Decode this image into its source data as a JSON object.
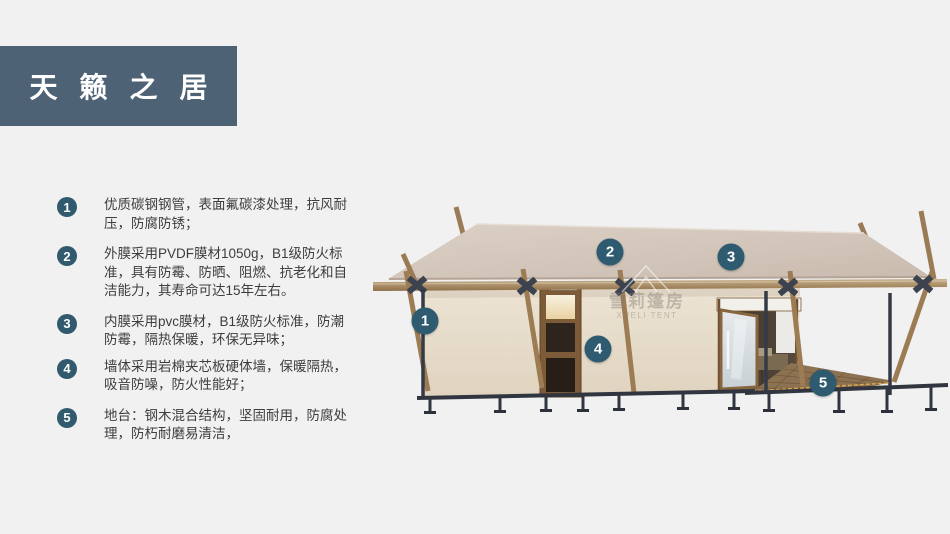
{
  "title": "天籁之居",
  "features": [
    {
      "num": "1",
      "text": "优质碳钢钢管，表面氟碳漆处理，抗风耐压，防腐防锈；"
    },
    {
      "num": "2",
      "text": "外膜采用PVDF膜材1050g，B1级防火标准，具有防霉、防晒、阻燃、抗老化和自洁能力，其寿命可达15年左右。"
    },
    {
      "num": "3",
      "text": "内膜采用pvc膜材，B1级防火标准，防潮防霉，隔热保暖，环保无异味；"
    },
    {
      "num": "4",
      "text": "墙体采用岩棉夹芯板硬体墙，保暖隔热，吸音防噪，防火性能好；"
    },
    {
      "num": "5",
      "text": "地台：钢木混合结构，坚固耐用，防腐处理，防朽耐磨易清洁，"
    }
  ],
  "figure": {
    "badges": [
      {
        "label": "1"
      },
      {
        "label": "2"
      },
      {
        "label": "3"
      },
      {
        "label": "4"
      },
      {
        "label": "5"
      }
    ],
    "watermark": {
      "cn": "雪莉篷房",
      "en": "XUELI TENT"
    }
  },
  "colors": {
    "background": "#f1f1f2",
    "banner": "#4d6375",
    "badge": "#2e5b70",
    "roof": "#d3c6ba",
    "wall": "#e9dfcf",
    "wood": "#9d7c54",
    "steel": "#353b46"
  }
}
